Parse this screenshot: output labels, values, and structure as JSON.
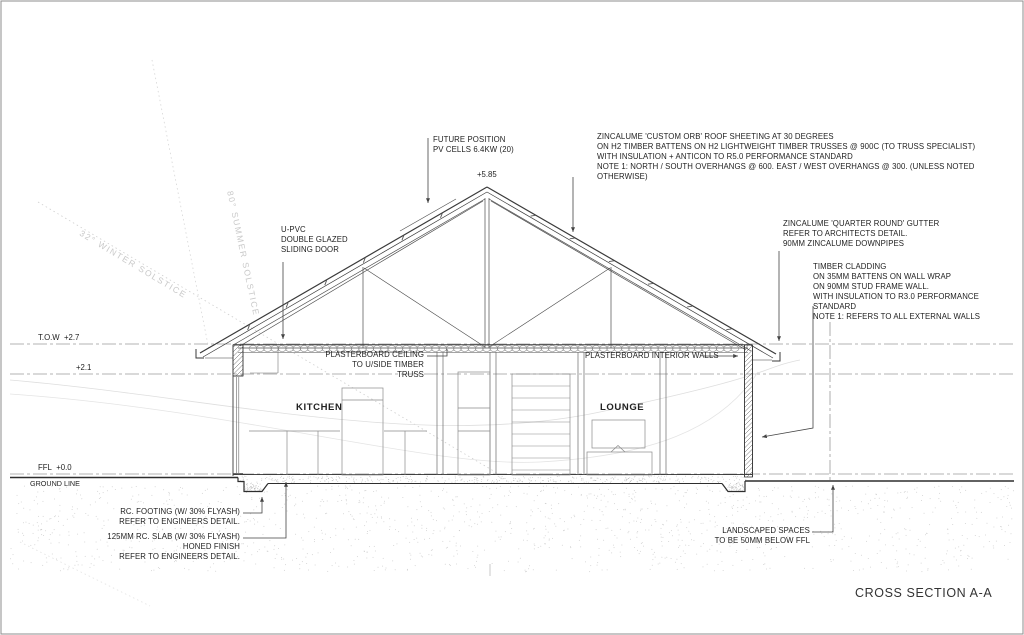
{
  "sheet": {
    "title": "CROSS SECTION A-A"
  },
  "levels": {
    "apex": "+5.85",
    "tow": "T.O.W  +2.7",
    "mid": "+2.1",
    "ffl": "FFL  +0.0",
    "ground": "GROUND LINE"
  },
  "rooms": {
    "kitchen": "KITCHEN",
    "lounge": "LOUNGE"
  },
  "sun": {
    "winter": "32° WINTER SOLSTICE",
    "summer": "80° SUMMER SOLSTICE"
  },
  "notes": {
    "pv": "FUTURE POSITION\nPV CELLS 6.4KW (20)",
    "roof": "ZINCALUME 'CUSTOM ORB' ROOF SHEETING AT 30 DEGREES\nON H2 TIMBER BATTENS ON H2 LIGHTWEIGHT TIMBER TRUSSES @ 900C (TO TRUSS SPECIALIST)\nWITH INSULATION  + ANTICON TO R5.0 PERFORMANCE STANDARD\nNOTE 1: NORTH / SOUTH OVERHANGS @ 600. EAST / WEST OVERHANGS @ 300. (UNLESS NOTED OTHERWISE)",
    "door": "U-PVC\nDOUBLE GLAZED\nSLIDING DOOR",
    "gutter": "ZINCALUME 'QUARTER ROUND' GUTTER\nREFER TO ARCHITECTS DETAIL.\n90MM ZINCALUME DOWNPIPES",
    "cladding": "TIMBER CLADDING\nON 35MM BATTENS ON WALL WRAP\nON 90MM STUD FRAME WALL.\nWITH INSULATION TO R3.0 PERFORMANCE STANDARD\nNOTE 1: REFERS TO ALL EXTERNAL WALLS",
    "ceiling": "PLASTERBOARD CEILING\nTO U/SIDE TIMBER TRUSS",
    "interior_walls": "PLASTERBOARD INTERIOR WALLS",
    "footing": "RC. FOOTING  (W/ 30% FLYASH)\nREFER TO ENGINEERS DETAIL.",
    "slab": "125MM RC. SLAB (W/ 30% FLYASH)\nHONED FINISH\nREFER TO ENGINEERS DETAIL.",
    "landscape": "LANDSCAPED SPACES\nTO BE 50MM BELOW FFL"
  },
  "colors": {
    "line": "#3a3a3a",
    "datum": "#9a9a9a",
    "faint": "#cfcfcf",
    "text": "#1f1f1f"
  }
}
